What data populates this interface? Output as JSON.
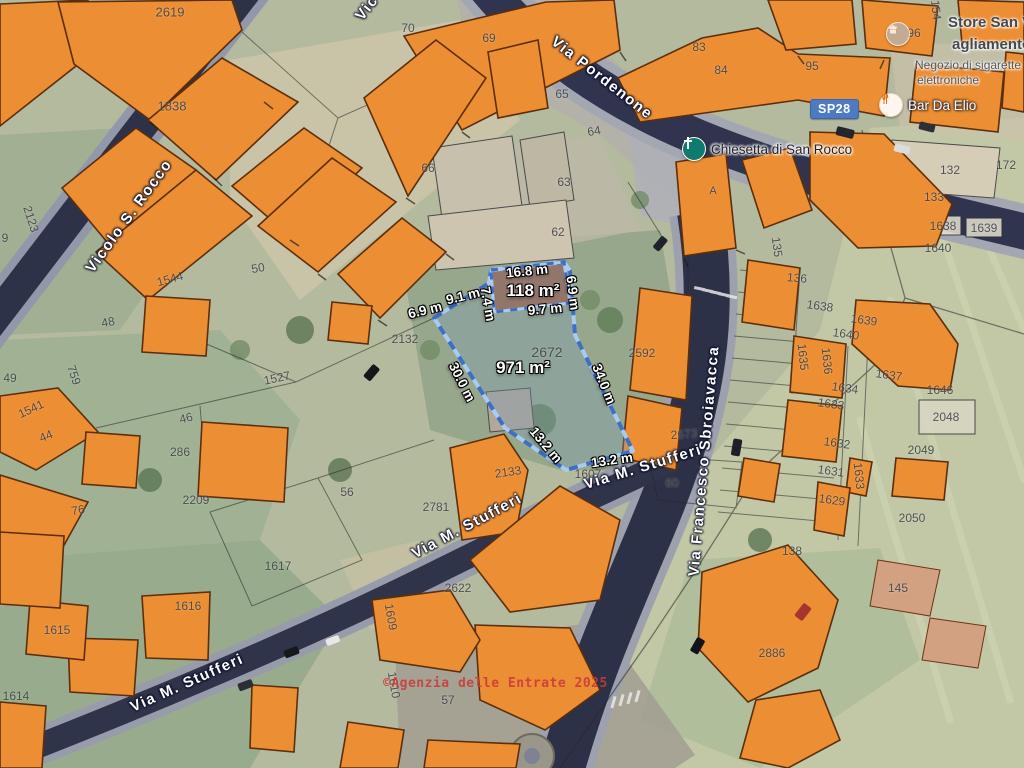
{
  "map_type": "satellite-cadastral",
  "route_badge": {
    "label": "SP28",
    "color": "#4d7ac2"
  },
  "attribution": {
    "watermark": "©Agenzia delle Entrate 2025",
    "color": "#ca3a3a"
  },
  "selected_parcel": {
    "number": "2672",
    "area_label": "971 m²",
    "building_area_label": "118 m²",
    "outline_color": "#3e6fc0",
    "edge_measurements": [
      "16.8 m",
      "6.9 m",
      "9.7 m",
      "7.4 m",
      "9.1 m",
      "6.9 m",
      "30.0 m",
      "34.0 m",
      "13.2 m",
      "13.2 m"
    ]
  },
  "pois": [
    {
      "id": "chiesetta",
      "icon": "church-cross-icon",
      "label": "Chiesetta di San Rocco",
      "x": 693,
      "y": 148
    },
    {
      "id": "bar",
      "icon": "restaurant-icon",
      "label": "Bar Da Elio",
      "x": 890,
      "y": 104
    },
    {
      "id": "store",
      "icon": "store-icon",
      "x": 897,
      "y": 33,
      "title_lines": [
        "Store San Vi",
        "agliamento c"
      ],
      "subtitle_lines": [
        "Negozio di sigarette",
        "elettroniche"
      ]
    }
  ],
  "street_labels": [
    {
      "t": "Via Pordenone",
      "x": 602,
      "y": 78,
      "r": 38
    },
    {
      "t": "Vicolo S. Rocco",
      "x": 129,
      "y": 216,
      "r": -54
    },
    {
      "t": "Vic",
      "x": 367,
      "y": 8,
      "r": -52
    },
    {
      "t": "Via M. Stufferi",
      "x": 467,
      "y": 526,
      "r": -28
    },
    {
      "t": "Via M. Stufferi",
      "x": 187,
      "y": 683,
      "r": -24
    },
    {
      "t": "Via M. Stufferi",
      "x": 643,
      "y": 467,
      "r": -17
    },
    {
      "t": "Via Francesco Sbroiavacca",
      "x": 704,
      "y": 461,
      "r": -85
    }
  ],
  "measure_labels": [
    {
      "t": "16.8 m",
      "x": 527,
      "y": 271,
      "r": -6
    },
    {
      "t": "118 m²",
      "x": 533,
      "y": 291,
      "r": 0,
      "area": true
    },
    {
      "t": "6.9 m",
      "x": 573,
      "y": 293,
      "r": 83
    },
    {
      "t": "9.7 m",
      "x": 545,
      "y": 309,
      "r": -5
    },
    {
      "t": "7.4 m",
      "x": 488,
      "y": 304,
      "r": 80
    },
    {
      "t": "9.1 m",
      "x": 463,
      "y": 296,
      "r": -14
    },
    {
      "t": "6.9 m",
      "x": 425,
      "y": 310,
      "r": -14
    },
    {
      "t": "30.0 m",
      "x": 462,
      "y": 382,
      "r": 63
    },
    {
      "t": "971 m²",
      "x": 523,
      "y": 368,
      "r": 0,
      "area": true
    },
    {
      "t": "34.0 m",
      "x": 604,
      "y": 384,
      "r": 68
    },
    {
      "t": "13.2 m",
      "x": 546,
      "y": 445,
      "r": 50
    },
    {
      "t": "13.2 m",
      "x": 612,
      "y": 460,
      "r": -8
    }
  ],
  "parcel_numbers": [
    {
      "t": "2672",
      "x": 547,
      "y": 352,
      "fs": 14
    },
    {
      "t": "2619",
      "x": 170,
      "y": 12,
      "fs": 13
    },
    {
      "t": "1838",
      "x": 172,
      "y": 106,
      "fs": 13
    },
    {
      "t": "2123",
      "x": 31,
      "y": 219,
      "r": 72
    },
    {
      "t": "9",
      "x": 5,
      "y": 238
    },
    {
      "t": "70",
      "x": 408,
      "y": 28
    },
    {
      "t": "69",
      "x": 489,
      "y": 38
    },
    {
      "t": "65",
      "x": 562,
      "y": 94
    },
    {
      "t": "83",
      "x": 699,
      "y": 47
    },
    {
      "t": "84",
      "x": 721,
      "y": 70
    },
    {
      "t": "95",
      "x": 812,
      "y": 66
    },
    {
      "t": "96",
      "x": 914,
      "y": 33
    },
    {
      "t": "154",
      "x": 936,
      "y": 10,
      "r": 84
    },
    {
      "t": "172",
      "x": 1006,
      "y": 165
    },
    {
      "t": "132",
      "x": 950,
      "y": 170
    },
    {
      "t": "133",
      "x": 934,
      "y": 197
    },
    {
      "t": "1638",
      "x": 943,
      "y": 226
    },
    {
      "t": "1639",
      "x": 984,
      "y": 228
    },
    {
      "t": "1640",
      "x": 938,
      "y": 248
    },
    {
      "t": "64",
      "x": 594,
      "y": 131,
      "r": -10
    },
    {
      "t": "66",
      "x": 428,
      "y": 168
    },
    {
      "t": "63",
      "x": 564,
      "y": 182
    },
    {
      "t": "62",
      "x": 558,
      "y": 232
    },
    {
      "t": "A",
      "x": 713,
      "y": 191,
      "fs": 11
    },
    {
      "t": "135",
      "x": 777,
      "y": 247,
      "r": 82
    },
    {
      "t": "136",
      "x": 797,
      "y": 278,
      "r": 5
    },
    {
      "t": "1638",
      "x": 820,
      "y": 306,
      "r": 8
    },
    {
      "t": "1639",
      "x": 864,
      "y": 320,
      "r": 8
    },
    {
      "t": "1640",
      "x": 846,
      "y": 334,
      "r": 8
    },
    {
      "t": "1635",
      "x": 803,
      "y": 357,
      "r": 84
    },
    {
      "t": "1636",
      "x": 827,
      "y": 361,
      "r": 84
    },
    {
      "t": "1637",
      "x": 889,
      "y": 375,
      "r": 8
    },
    {
      "t": "1634",
      "x": 845,
      "y": 388,
      "r": 8
    },
    {
      "t": "1633",
      "x": 831,
      "y": 404,
      "r": 8
    },
    {
      "t": "1646",
      "x": 940,
      "y": 390
    },
    {
      "t": "2048",
      "x": 946,
      "y": 417
    },
    {
      "t": "1632",
      "x": 837,
      "y": 443,
      "r": 8
    },
    {
      "t": "2049",
      "x": 921,
      "y": 450
    },
    {
      "t": "1631",
      "x": 831,
      "y": 471,
      "r": 8
    },
    {
      "t": "1633",
      "x": 859,
      "y": 476,
      "r": 84
    },
    {
      "t": "1629",
      "x": 832,
      "y": 500,
      "r": 8
    },
    {
      "t": "2050",
      "x": 912,
      "y": 518
    },
    {
      "t": "138",
      "x": 792,
      "y": 551
    },
    {
      "t": "145",
      "x": 898,
      "y": 588
    },
    {
      "t": "2886",
      "x": 772,
      "y": 653
    },
    {
      "t": "2592",
      "x": 642,
      "y": 353
    },
    {
      "t": "2673",
      "x": 684,
      "y": 434,
      "r": -5
    },
    {
      "t": "60",
      "x": 672,
      "y": 483
    },
    {
      "t": "1607",
      "x": 588,
      "y": 474
    },
    {
      "t": "2133",
      "x": 508,
      "y": 472,
      "r": -8
    },
    {
      "t": "2781",
      "x": 436,
      "y": 507
    },
    {
      "t": "2622",
      "x": 458,
      "y": 588
    },
    {
      "t": "1609",
      "x": 391,
      "y": 617,
      "r": 80
    },
    {
      "t": "1610",
      "x": 394,
      "y": 685,
      "r": 80
    },
    {
      "t": "57",
      "x": 448,
      "y": 700
    },
    {
      "t": "56",
      "x": 347,
      "y": 492
    },
    {
      "t": "2132",
      "x": 405,
      "y": 339
    },
    {
      "t": "1527",
      "x": 277,
      "y": 378,
      "r": -12
    },
    {
      "t": "1544",
      "x": 170,
      "y": 279,
      "r": -15
    },
    {
      "t": "50",
      "x": 258,
      "y": 268,
      "r": -10
    },
    {
      "t": "48",
      "x": 108,
      "y": 322,
      "r": -10
    },
    {
      "t": "759",
      "x": 74,
      "y": 375,
      "r": 72
    },
    {
      "t": "1541",
      "x": 31,
      "y": 409,
      "r": -25
    },
    {
      "t": "44",
      "x": 46,
      "y": 436,
      "r": -22
    },
    {
      "t": "46",
      "x": 186,
      "y": 418,
      "r": -14
    },
    {
      "t": "49",
      "x": 10,
      "y": 378
    },
    {
      "t": "286",
      "x": 180,
      "y": 452
    },
    {
      "t": "2209",
      "x": 196,
      "y": 500
    },
    {
      "t": "76",
      "x": 78,
      "y": 510,
      "r": -10
    },
    {
      "t": "1617",
      "x": 278,
      "y": 566
    },
    {
      "t": "1616",
      "x": 188,
      "y": 606
    },
    {
      "t": "1615",
      "x": 57,
      "y": 630
    },
    {
      "t": "1614",
      "x": 16,
      "y": 696
    }
  ],
  "colors": {
    "building_fill": "#EC8E33",
    "building_stroke": "#5D2E0C",
    "road_dark": "#2e3248",
    "road_light": "#9aa0ae",
    "field": "#c2c8a6",
    "green": "#9cb091",
    "parcel_fill": "rgba(125,155,180,0.32)",
    "parcel_building_fill": "rgba(148,103,92,0.75)",
    "parcel_border_light": "#a9cbf0",
    "parcel_border_dark": "#3e6fc0"
  }
}
